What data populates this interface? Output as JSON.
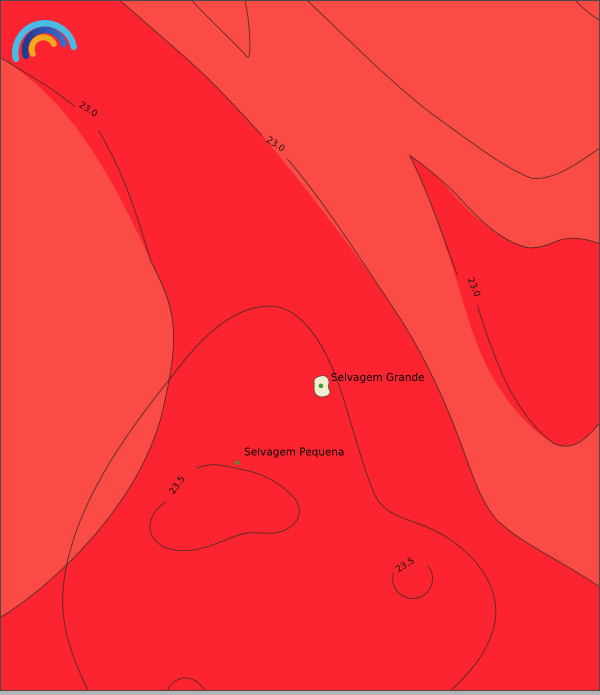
{
  "map": {
    "colors": {
      "sea_warm_red": "#fb2430",
      "sea_cool_red": "#fb4b45",
      "contour_line": "#3b2b27",
      "island_fill": "#f2ecd0",
      "island_stroke": "#55503f",
      "marker_green": "#2fa32f",
      "frame": "#4a4a4a",
      "bottom_strip": "#b4b4b4"
    },
    "contour_labels": [
      "23.0",
      "23.0",
      "23.0",
      "23.5",
      "23.5"
    ],
    "places": [
      {
        "name": "Selvagem Grande"
      },
      {
        "name": "Selvagem Pequena"
      }
    ],
    "logo": {
      "name": "rainbow-arcs-logo",
      "arc_colors": [
        "#49bbe6",
        "#24408f",
        "#f5a71d"
      ]
    }
  }
}
